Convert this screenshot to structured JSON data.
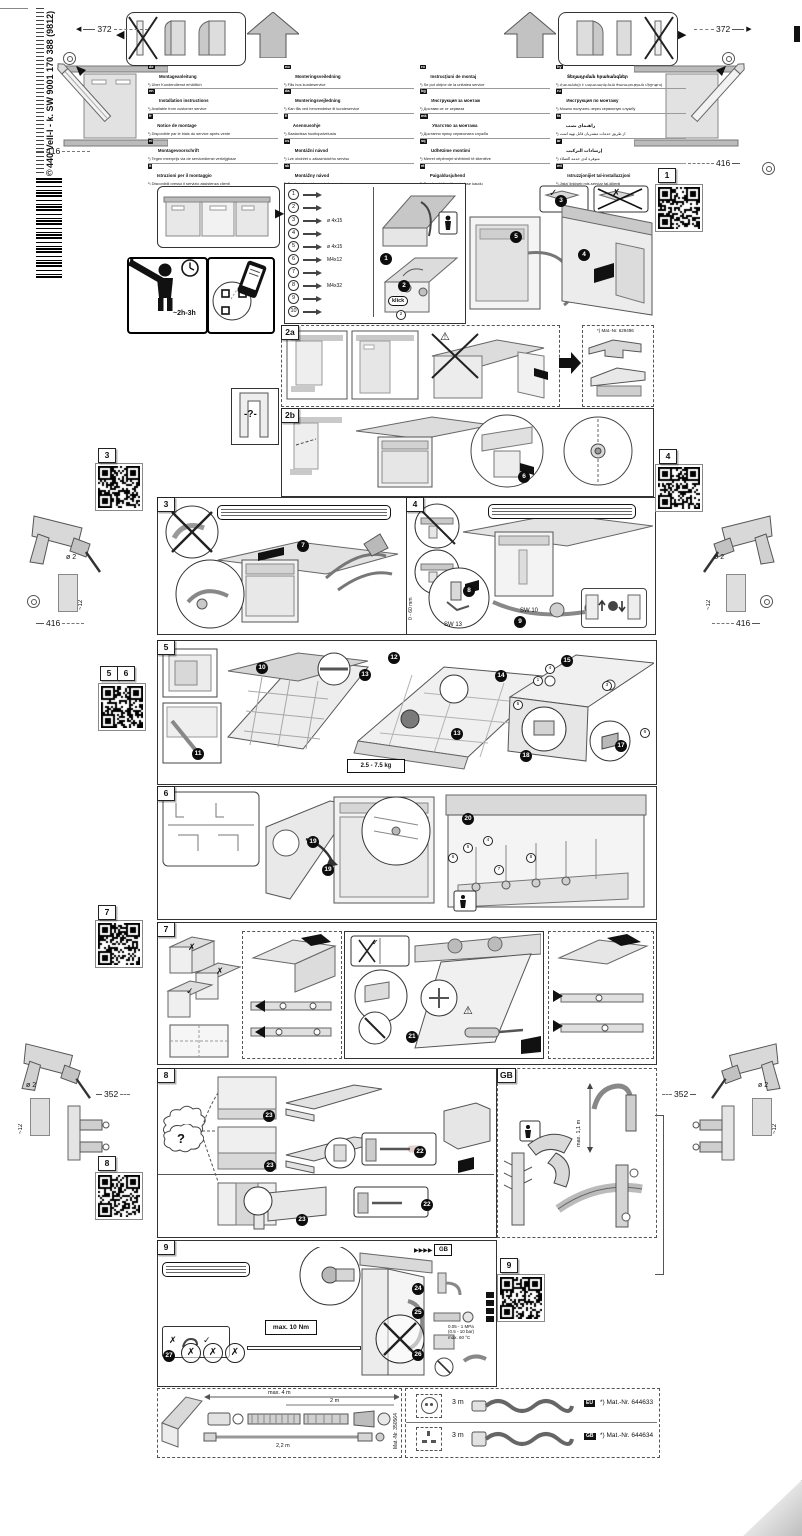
{
  "doc": {
    "code_vertical": "440 VeII-I - k. SW  9001 170 388 (9812)",
    "copyright": "©"
  },
  "sections": {
    "s1": "1",
    "s2a": "2a",
    "s2b": "2b",
    "s3": "3",
    "s4": "4",
    "s5": "5",
    "s6": "6",
    "s7": "7",
    "s8": "8",
    "s9": "9",
    "gb": "GB"
  },
  "qr": {
    "q1": "1",
    "q3": "3",
    "q4": "4",
    "q5": "5",
    "q6": "6",
    "q7": "7",
    "q8": "8",
    "q9": "9"
  },
  "steps": {
    "n1": "1",
    "n2": "2",
    "n3": "3",
    "n4": "4",
    "n5": "5",
    "n6": "6",
    "n7": "7",
    "n8": "8",
    "n9": "9",
    "n10": "10",
    "n11": "11",
    "n12": "12",
    "n13": "13",
    "n14": "14",
    "n15": "15",
    "n16": "16",
    "n17": "17",
    "n18": "18",
    "n19": "19",
    "n20": "20",
    "n21": "21",
    "n22": "22",
    "n23": "23",
    "n24": "24",
    "n25": "25",
    "n26": "26",
    "n27": "27"
  },
  "marks": {
    "check": "✓",
    "cross": "✗",
    "warn": "⚠",
    "question_panel": "-?-",
    "question_cloud": "?",
    "klick": "klick",
    "gb_arrows": "▶▶▶▶",
    "tri_left": "◀",
    "tri_right": "▶"
  },
  "dims": {
    "d372": "372",
    "d416": "416",
    "d352": "352",
    "drill_dia": "ø 2",
    "drill_depth": "~12",
    "adjust": "0 - 60 mm",
    "sw13": "SW 13",
    "sw10": "SW 10",
    "panel_weight": "2.5 - 7.5 kg",
    "hose_height": "max. 1,1 m",
    "torque": "max. 10 Nm",
    "time": "~2h-3h"
  },
  "water": {
    "pressure1": "0.05 - 1 MPa",
    "pressure2": "(0.5 - 10 bar)",
    "temp": "max. 60 °C"
  },
  "notes": {
    "pinch": [
      "nicht einklemmen",
      "do not pinch",
      "ne pas coincer",
      "No doblar"
    ],
    "brace": [
      "verspannen",
      "brace",
      "caler verticalement",
      "Enrasar"
    ],
    "disc": [
      "Scheibe entfernen",
      "remove disc",
      "enlever le disque",
      "Eliminar Disco"
    ],
    "leak": [
      "Dichtheit nach einem Spülgang prüfen.",
      "Check for leaks after one wash cycle.",
      "Vérifiez l'étanchéité après un lavage.",
      "Verificar la estanqueidad tras un ciclo de lavado."
    ],
    "bracket_part": "*) Mat.-Nr. 629496"
  },
  "parts": [
    {
      "num": "1",
      "label": ""
    },
    {
      "num": "2",
      "label": ""
    },
    {
      "num": "3",
      "label": "ø 4x15"
    },
    {
      "num": "4",
      "label": ""
    },
    {
      "num": "5",
      "label": "ø 4x15"
    },
    {
      "num": "6",
      "label": "M4x12"
    },
    {
      "num": "7",
      "label": ""
    },
    {
      "num": "8",
      "label": "M4x32"
    },
    {
      "num": "9",
      "label": ""
    },
    {
      "num": "10",
      "label": ""
    }
  ],
  "languages": {
    "col1": [
      {
        "code": "de",
        "title": "Montageanleitung",
        "note": "¹) Über Kundendienst erhältlich"
      },
      {
        "code": "en",
        "title": "Installation instructions",
        "note": "¹) Available from customer service"
      },
      {
        "code": "fr",
        "title": "Notice de montage",
        "note": "¹) Disponible par le biais du service après-vente"
      },
      {
        "code": "nl",
        "title": "Montagevoorschrift",
        "note": "¹) Tegen meerprijs via de servicedienst verkrijgbaar"
      },
      {
        "code": "it",
        "title": "Istruzioni per il montaggio",
        "note": "¹) Disponibili presso il servizio assistenza clienti"
      },
      {
        "code": "es",
        "title": "Instrucciones de montaje",
        "note": "¹) A través del Servicio de Asistencia Técnica/Oficial de recambios"
      },
      {
        "code": "pt",
        "title": "Instruções de montagem",
        "note": "¹) Pode ser adquirido através dos Serviços Técnicos"
      },
      {
        "code": "el",
        "title": "Οδηγίες τοποθέτησης",
        "note": "¹) Διατίθεται από την υπηρεσία εξυπηρέτησης πελατών"
      },
      {
        "code": "tr",
        "title": "Montaj kılavuzu",
        "note": "¹) Yetkili servisten temin edilebilir"
      },
      {
        "code": "sv",
        "title": "Monteringsanvisning",
        "note": "¹) Kan fås via service"
      }
    ],
    "col2": [
      {
        "code": "no",
        "title": "Monteringsveiledning",
        "note": "¹) Fås hos kundeservice"
      },
      {
        "code": "da",
        "title": "Monteringsvejledning",
        "note": "¹) Kan fås ved henvendelse til kundeservice"
      },
      {
        "code": "fi",
        "title": "Asennusohje",
        "note": "¹) Saatavissa huoltopalvelusta"
      },
      {
        "code": "cs",
        "title": "Montážní návod",
        "note": "¹) Lze obdržet u zákaznického servisu"
      },
      {
        "code": "sk",
        "title": "Montážny návod",
        "note": "¹) Dostupné u zákazníckeho servisu"
      },
      {
        "code": "pl",
        "title": "Instrukcja montażu",
        "note": "¹) Do nabycia w serwisie producenta"
      },
      {
        "code": "hu",
        "title": "Szerelési útmutató",
        "note": "¹) A vevőszolgálatnál szerezhető be"
      },
      {
        "code": "sl",
        "title": "Navodila za montažo",
        "note": "¹) Na voljo pri servisni službi"
      },
      {
        "code": "hr",
        "title": "Upute za montažu",
        "note": "¹) Mogu se dobiti kod servisne službe"
      },
      {
        "code": "sr",
        "title": "Uputstvo za montažu",
        "note": "¹) Može se nabaviti preko servisne službe"
      }
    ],
    "col3": [
      {
        "code": "ro",
        "title": "Instrucţiuni de montaj",
        "note": "¹) Se pot obţine de la unitatea service"
      },
      {
        "code": "bg",
        "title": "Инструкция за монтаж",
        "note": "¹) Доставя се от сервиза"
      },
      {
        "code": "mk",
        "title": "Упатство за монтажа",
        "note": "¹) Достапно преку сервисната служба"
      },
      {
        "code": "sq",
        "title": "Udhëzime montimi",
        "note": "¹) Merret nëpërmjet shërbimit të klientëve"
      },
      {
        "code": "et",
        "title": "Paigaldusjuhend",
        "note": "¹) Saadaval klienditeeninduse kaudu"
      },
      {
        "code": "lv",
        "title": "Montāžas instrukcija",
        "note": "¹) Pieejama klientu servisā"
      },
      {
        "code": "lt",
        "title": "Montavimo instrukcija",
        "note": "¹) Galima gauti klientų aptarnavimo tarnyboje"
      },
      {
        "code": "uk",
        "title": "Інструкція з монтажу",
        "note": "¹) Можна отримати через сервісну службу"
      },
      {
        "code": "kk",
        "title": "Монтаждау нұсқаулығы",
        "note": "¹) Сервистік қызмет арқылы алуға болады"
      },
      {
        "code": "ka",
        "title": "მონტაჟის ინსტრუქცია",
        "note": "¹) ხელმისაწვდომია სერვისცენტრში"
      }
    ],
    "col4": [
      {
        "code": "hy",
        "title": "Տեղադրման հրահանգներ",
        "note": "¹) Հասանելի է սպասարկման ծառայության միջոցով"
      },
      {
        "code": "ru",
        "title": "Инструкция по монтажу",
        "note": "¹) Можно получить через сервисную службу"
      },
      {
        "code": "fa",
        "title": "راهنمای نصب",
        "note": "¹) از طریق خدمات مشتریان قابل تهیه است"
      },
      {
        "code": "ar",
        "title": "إرشادات التركيب",
        "note": "¹) متوفرة لدى خدمة العملاء"
      },
      {
        "code": "mt",
        "title": "Istruzzjonijiet tal-installazzjoni",
        "note": "¹) Jista' jinkiseb mis-servizz tal-klijenti"
      },
      {
        "code": "th",
        "title": "คำแนะนำในการติดตั้ง",
        "note": "¹) ขอรับได้จากฝ่ายบริการลูกค้า"
      },
      {
        "code": "ko",
        "title": "설치 설명서",
        "note": "¹) 서비스 센터에서 구입 가능"
      },
      {
        "code": "zh",
        "title": "安装说明",
        "note": "¹) 可向客户服务部索取"
      },
      {
        "code": "zh-TW",
        "title": "安裝說明",
        "note": "¹) 可向客戶服務部門索取"
      }
    ]
  },
  "bottom": {
    "hose": {
      "max_len": "max. 4 m",
      "len1": "2 m",
      "len2": "2,2 m",
      "mat": "Mat.-Nr. 350564"
    },
    "cords": [
      {
        "badge": "EU",
        "length": "3 m",
        "mat": "*) Mat.-Nr. 644633"
      },
      {
        "badge": "GB",
        "length": "3 m",
        "mat": "*) Mat.-Nr. 644634"
      }
    ]
  }
}
